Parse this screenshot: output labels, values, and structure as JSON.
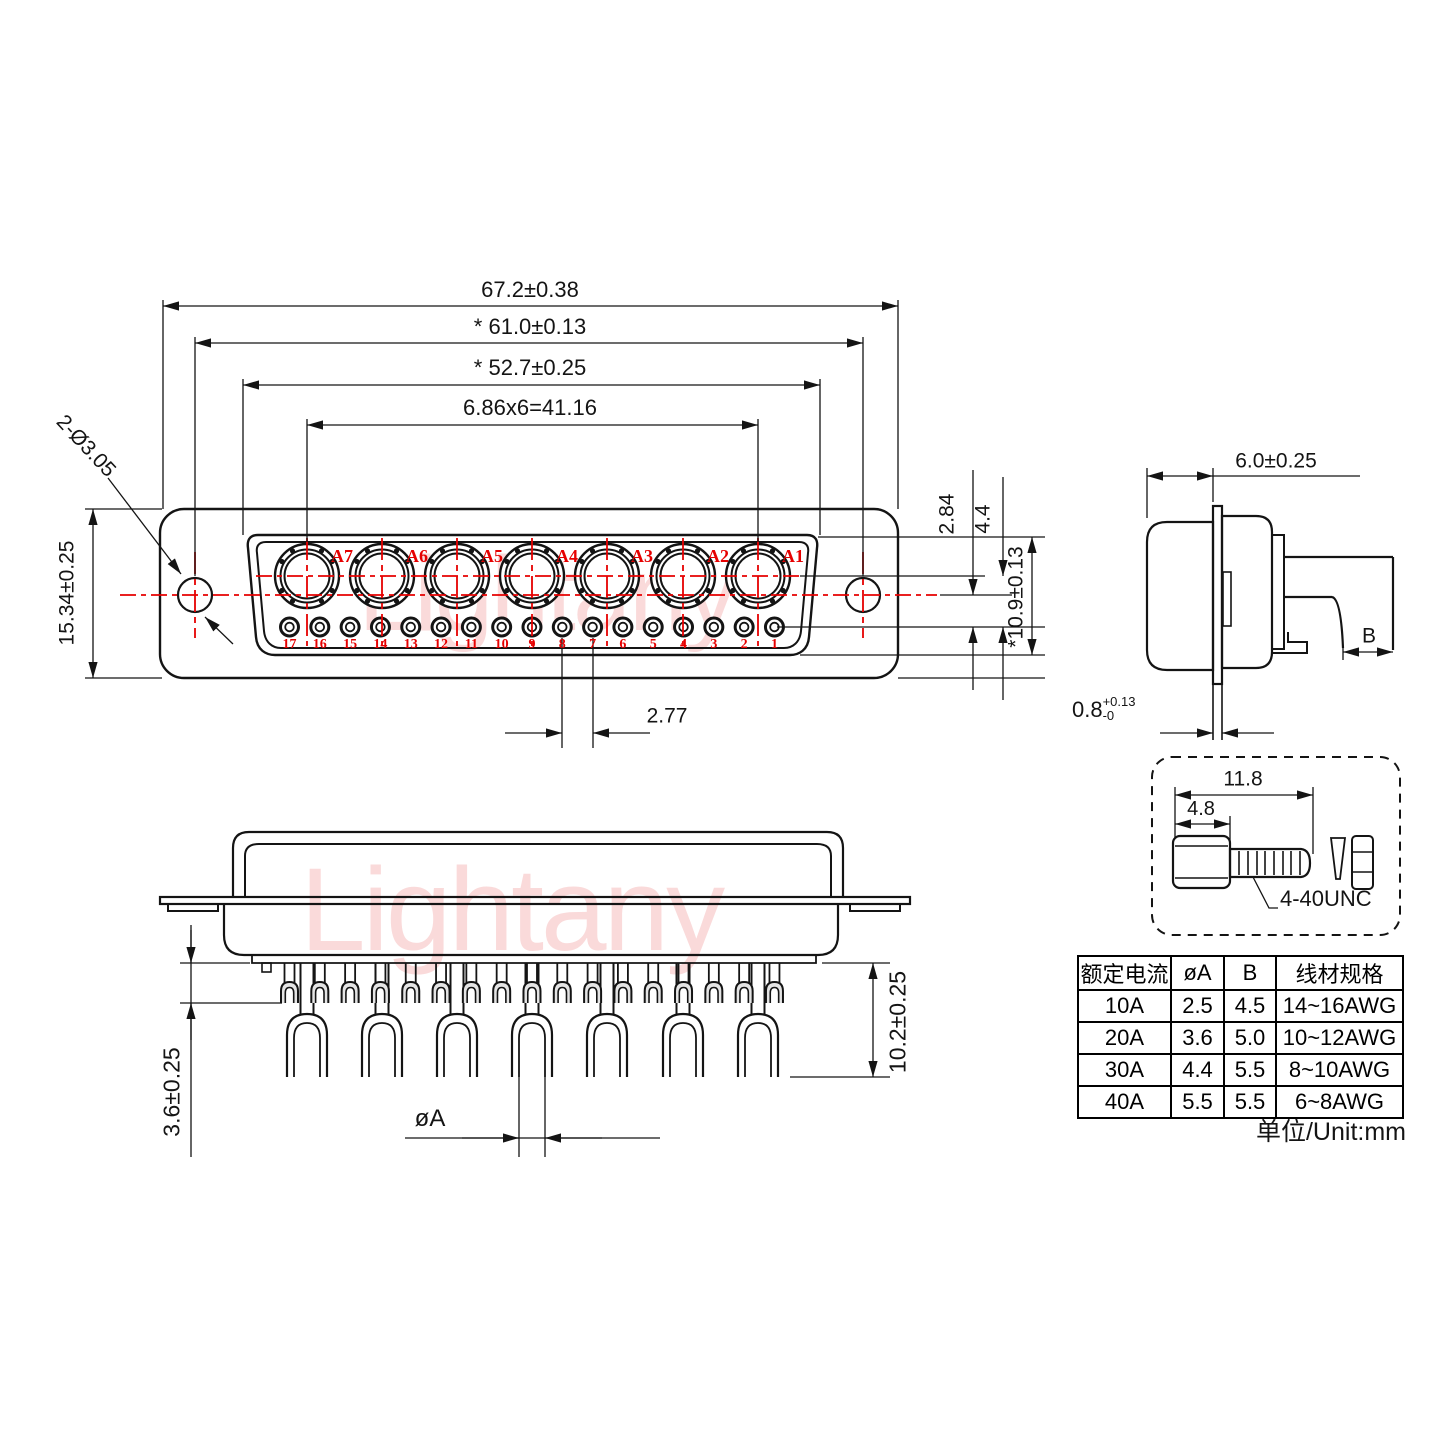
{
  "front_view": {
    "dims": {
      "overall_width": "67.2±0.38",
      "hole_span": "* 61.0±0.13",
      "shell_width": "* 52.7±0.25",
      "coax_pitch": "6.86x6=41.16",
      "height": "15.34±0.25",
      "mounting_holes": "2-Ø3.05",
      "hole_to_pin_row": "2.84",
      "coax_to_pin_row": "4.4",
      "shell_height": "*10.9±0.13",
      "pin_pitch": "2.77"
    },
    "coax_labels": [
      "A7",
      "A6",
      "A5",
      "A4",
      "A3",
      "A2",
      "A1"
    ],
    "pin_numbers": [
      "17",
      "16",
      "15",
      "14",
      "13",
      "12",
      "11",
      "10",
      "9",
      "8",
      "7",
      "6",
      "5",
      "4",
      "3",
      "2",
      "1"
    ]
  },
  "side_view": {
    "dims": {
      "depth": "6.0±0.25",
      "tail_width": "B",
      "flange_thickness_base": "0.8",
      "flange_thickness_plus": "+0.13",
      "flange_thickness_minus": "-0"
    }
  },
  "screw_detail": {
    "dims": {
      "total_length": "11.8",
      "head_length": "4.8"
    },
    "thread_label": "4-40UNC"
  },
  "section_view": {
    "dims": {
      "insulator_height": "3.6±0.25",
      "cup_depth": "10.2±0.25",
      "cup_bore": "øA"
    }
  },
  "table": {
    "headers": [
      "额定电流",
      "øA",
      "B",
      "线材规格"
    ],
    "rows": [
      [
        "10A",
        "2.5",
        "4.5",
        "14~16AWG"
      ],
      [
        "20A",
        "3.6",
        "5.0",
        "10~12AWG"
      ],
      [
        "30A",
        "4.4",
        "5.5",
        "8~10AWG"
      ],
      [
        "40A",
        "5.5",
        "5.5",
        "6~8AWG"
      ]
    ],
    "unit_note": "单位/Unit:mm"
  },
  "watermark": {
    "text": "Lightany"
  },
  "colors": {
    "line": "#141414",
    "accent_red": "#e60000",
    "watermark_pink": "#f2a6a6"
  }
}
